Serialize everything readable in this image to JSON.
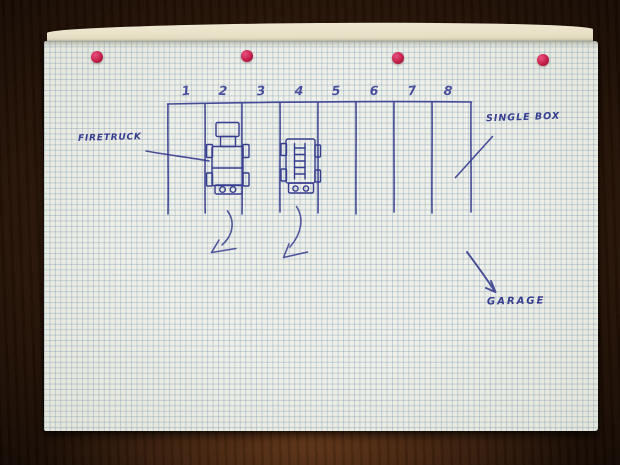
{
  "diagram": {
    "title_context": "hand-drawn garage plan on squared paper",
    "box_numbers": [
      "1",
      "2",
      "3",
      "4",
      "5",
      "6",
      "7",
      "8"
    ],
    "labels": {
      "firetruck": "FIRETRUCK",
      "single_box": "SINGLE BOX",
      "garage": "GARAGE"
    },
    "vehicles": [
      {
        "name": "firetruck",
        "parked_in_box": "2"
      },
      {
        "name": "fire-ladder-truck",
        "parked_in_box": "4"
      }
    ],
    "pins": {
      "count": 4,
      "color": "#c42049"
    },
    "colors": {
      "ink": "#373d8f",
      "ink_light": "#4a4f9d",
      "paper": "#eaece4",
      "back_sheet": "#e9e2c8",
      "wood_dark": "#24120a",
      "wood_mid": "#462814"
    }
  }
}
